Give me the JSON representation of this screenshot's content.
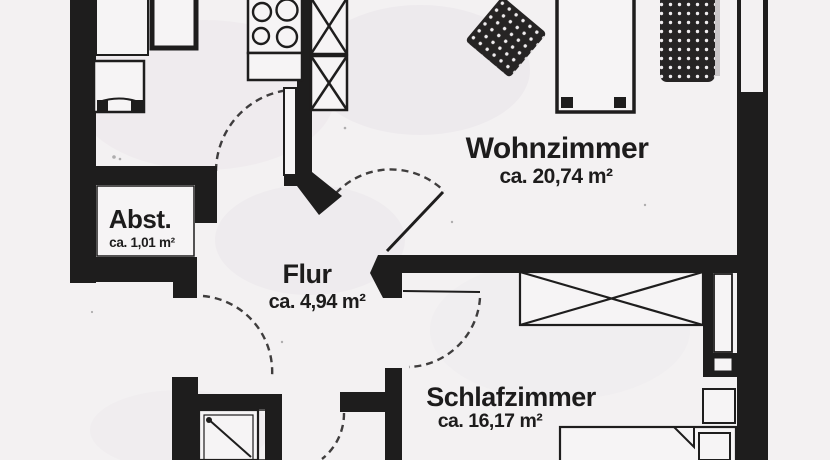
{
  "floorplan": {
    "rooms": [
      {
        "name": "Wohnzimmer",
        "area": "ca. 20,74 m²"
      },
      {
        "name": "Flur",
        "area": "ca. 4,94 m²"
      },
      {
        "name": "Abst.",
        "area": "ca. 1,01 m²"
      },
      {
        "name": "Schlafzimmer",
        "area": "ca. 16,17 m²"
      }
    ],
    "symbols": [
      "stove-burners-icon",
      "sink-icon",
      "kitchen-appliance-icon",
      "tall-cabinet-x-icon",
      "wardrobe-x-icon",
      "shower-icon",
      "bed-icon",
      "pillow-icon",
      "table-icon",
      "armchair-icon",
      "sofa-icon",
      "door-swing-arc",
      "window-symbol",
      "radiator-icon"
    ],
    "colors": {
      "wall": "#1e1d1d",
      "paper": "#f3f1f2",
      "room": "#f6f4f5",
      "furniture": "#262424",
      "text": "#1d1c1c"
    }
  }
}
